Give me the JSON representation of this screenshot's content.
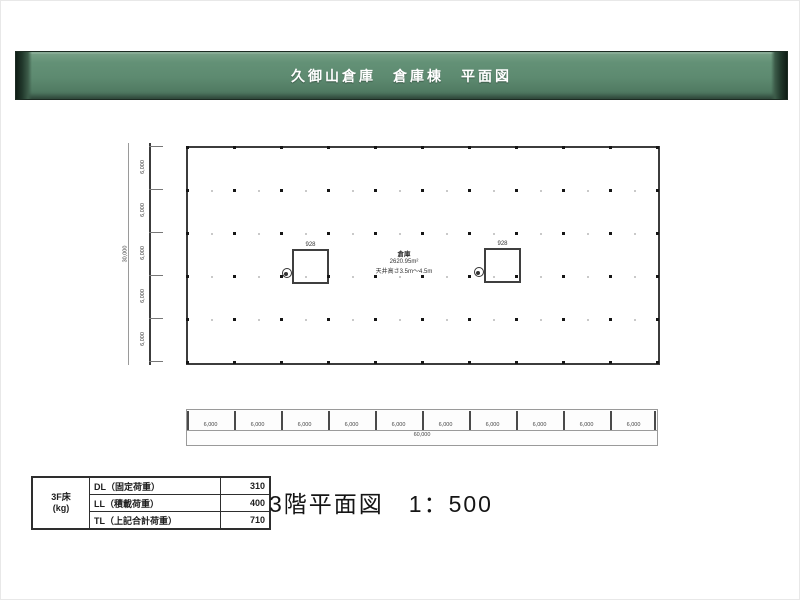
{
  "header": {
    "title": "久御山倉庫　倉庫棟　平面図",
    "bg_color": "#5d8a70",
    "cap_color": "#101d16",
    "text_color": "#ffffff"
  },
  "plan": {
    "room": {
      "name": "倉庫",
      "area": "2620.95m²",
      "ceiling": "天井高さ3.5m〜4.5m"
    },
    "grid": {
      "bays_x": 10,
      "bays_y": 5
    },
    "shafts": [
      {
        "label": "928"
      },
      {
        "label": "928"
      }
    ]
  },
  "dimensions": {
    "bottom": {
      "segments": [
        "6,000",
        "6,000",
        "6,000",
        "6,000",
        "6,000",
        "6,000",
        "6,000",
        "6,000",
        "6,000",
        "6,000"
      ],
      "total": "60,000"
    },
    "left": {
      "segments": [
        "6,000",
        "6,000",
        "6,000",
        "6,000",
        "6,000"
      ],
      "total": "30,000"
    }
  },
  "load_table": {
    "row_header": "3F床",
    "row_header_unit": "(kg)",
    "rows": [
      {
        "label": "DL（固定荷重）",
        "value": "310"
      },
      {
        "label": "LL（積載荷重）",
        "value": "400"
      },
      {
        "label": "TL（上記合計荷重）",
        "value": "710"
      }
    ]
  },
  "caption": "3階平面図　1：500"
}
